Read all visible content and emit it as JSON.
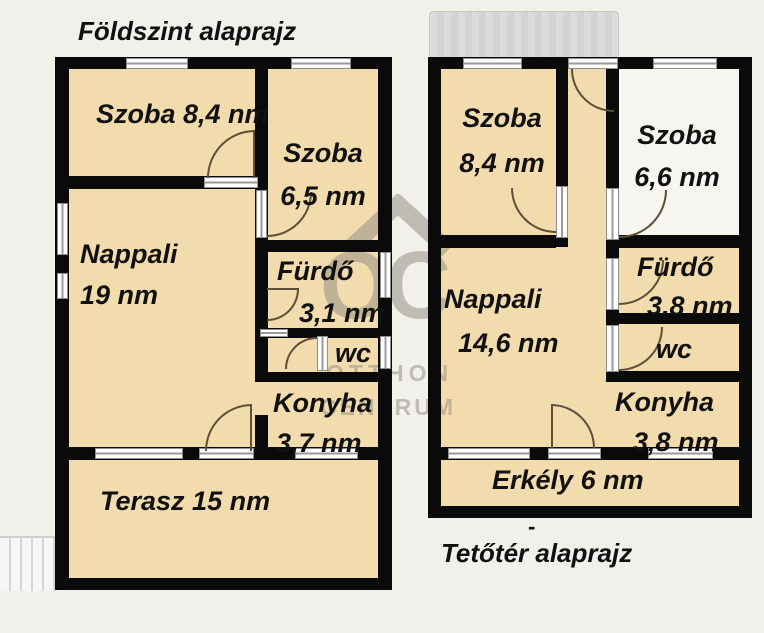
{
  "left_plan": {
    "title": "Földszint alaprajz",
    "szoba1": "Szoba 8,4 nm",
    "szoba2_name": "Szoba",
    "szoba2_area": "6,5 nm",
    "nappali_name": "Nappali",
    "nappali_area": "19 nm",
    "furdo_name": "Fürdő",
    "furdo_area": "3,1 nm",
    "wc": "wc",
    "konyha_name": "Konyha",
    "konyha_area": "3,7 nm",
    "terasz": "Terasz 15 nm"
  },
  "right_plan": {
    "title": "Tetőtér alaprajz",
    "title_mark": "-",
    "szoba1_name": "Szoba",
    "szoba1_area": "8,4 nm",
    "szoba2_name": "Szoba",
    "szoba2_area": "6,6 nm",
    "nappali_name": "Nappali",
    "nappali_area": "14,6 nm",
    "furdo_name": "Fürdő",
    "furdo_area": "3,8 nm",
    "wc": "wc",
    "konyha_name": "Konyha",
    "konyha_area": "3,8 nm",
    "erkely": "Erkély 6 nm"
  },
  "watermark": {
    "logo_text": "OC",
    "line1": "OTTHON",
    "line2": "CENTRUM"
  },
  "colors": {
    "background": "#f1f0eb",
    "room_fill": "#f2dbad",
    "wall": "#0a0a0a",
    "watermark": "#8e8a82"
  }
}
